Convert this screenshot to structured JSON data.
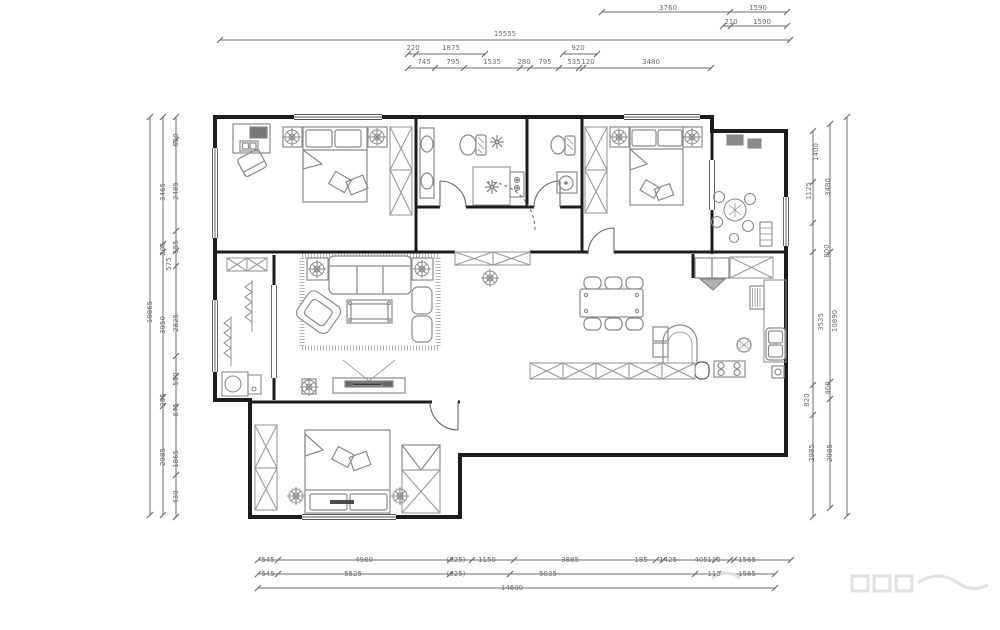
{
  "drawing": {
    "type": "residential-floor-plan",
    "units": "mm"
  },
  "colors": {
    "wall": "#1c1c1c",
    "furniture": "#8a8a8a",
    "dimension": "#6d6d6d",
    "hatch": "#9a9a9a",
    "background": "#ffffff"
  },
  "dimension_labels": {
    "top": [
      [
        "3760",
        668,
        8
      ],
      [
        "1590",
        758,
        8
      ],
      [
        "210",
        731,
        22
      ],
      [
        "1590",
        762,
        22
      ],
      [
        "15555",
        505,
        34
      ],
      [
        "220",
        413,
        48
      ],
      [
        "1875",
        451,
        48
      ],
      [
        "920",
        578,
        48
      ],
      [
        "745",
        424,
        62
      ],
      [
        "795",
        453,
        62
      ],
      [
        "1535",
        492,
        62
      ],
      [
        "280",
        524,
        62
      ],
      [
        "795",
        545,
        62
      ],
      [
        "535",
        574,
        62
      ],
      [
        "120",
        588,
        62
      ],
      [
        "3480",
        651,
        62
      ]
    ],
    "left": [
      [
        "10865",
        150,
        312
      ],
      [
        "3465",
        163,
        192
      ],
      [
        "205",
        163,
        249
      ],
      [
        "3950",
        163,
        325
      ],
      [
        "255",
        163,
        400
      ],
      [
        "2985",
        163,
        457
      ],
      [
        "620",
        176,
        140
      ],
      [
        "2485",
        176,
        191
      ],
      [
        "555",
        176,
        247
      ],
      [
        "575",
        169,
        264
      ],
      [
        "2825",
        176,
        323
      ],
      [
        "550",
        176,
        379
      ],
      [
        "845",
        176,
        410
      ],
      [
        "1865",
        176,
        459
      ],
      [
        "430",
        176,
        497
      ]
    ],
    "right": [
      [
        "1400",
        816,
        152
      ],
      [
        "1125",
        809,
        191
      ],
      [
        "3480",
        828,
        187
      ],
      [
        "800",
        827,
        251
      ],
      [
        "3535",
        821,
        322
      ],
      [
        "10890",
        835,
        321
      ],
      [
        "460",
        828,
        388
      ],
      [
        "820",
        807,
        400
      ],
      [
        "2985",
        812,
        453
      ],
      [
        "2985",
        830,
        453
      ]
    ],
    "bottom": [
      [
        "545",
        268,
        560
      ],
      [
        "4980",
        364,
        560
      ],
      [
        "(825)",
        456,
        560
      ],
      [
        "1150",
        487,
        560
      ],
      [
        "3885",
        570,
        560
      ],
      [
        "185",
        641,
        560
      ],
      [
        "1425",
        668,
        560
      ],
      [
        "405",
        701,
        560
      ],
      [
        "110",
        714,
        560
      ],
      [
        "1565",
        747,
        560
      ],
      [
        "545",
        268,
        574
      ],
      [
        "5525",
        353,
        574
      ],
      [
        "(825)",
        456,
        574
      ],
      [
        "5035",
        548,
        574
      ],
      [
        "110",
        714,
        574
      ],
      [
        "1565",
        747,
        574
      ],
      [
        "14600",
        512,
        588
      ]
    ]
  }
}
